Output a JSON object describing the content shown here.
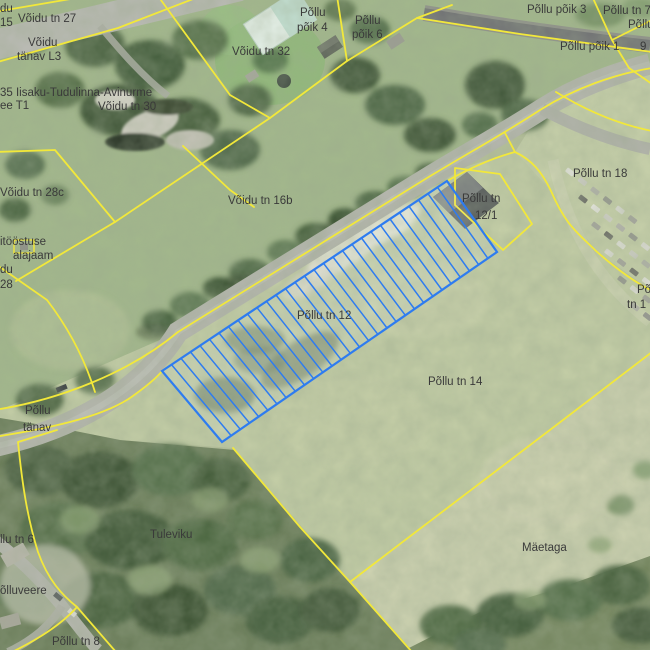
{
  "map": {
    "colors": {
      "boundary_yellow": "#f2e83a",
      "selection_blue": "#2e7cf0",
      "label_gray": "#3a3a3a"
    },
    "selected_parcel": {
      "label": "Põllu tn 12",
      "polygon": [
        [
          162,
          371
        ],
        [
          447,
          181
        ],
        [
          497,
          252
        ],
        [
          222,
          442
        ]
      ],
      "hatch_line_count": 30
    },
    "labels": [
      {
        "text": "du",
        "x": 0,
        "y": 12
      },
      {
        "text": "15",
        "x": 0,
        "y": 26
      },
      {
        "text": "Võidu tn 27",
        "x": 18,
        "y": 22
      },
      {
        "text": "Võidu",
        "x": 28,
        "y": 46
      },
      {
        "text": "tänav L3",
        "x": 17,
        "y": 60
      },
      {
        "text": "35 Iisaku-Tudulinna-Avinurme",
        "x": 0,
        "y": 96
      },
      {
        "text": "ee T1",
        "x": 0,
        "y": 109
      },
      {
        "text": "Võidu tn 30",
        "x": 98,
        "y": 110
      },
      {
        "text": "Võidu tn 32",
        "x": 232,
        "y": 55
      },
      {
        "text": "Põllu",
        "x": 300,
        "y": 16
      },
      {
        "text": "põik 4",
        "x": 297,
        "y": 31
      },
      {
        "text": "Põllu",
        "x": 355,
        "y": 24
      },
      {
        "text": "põik 6",
        "x": 352,
        "y": 38
      },
      {
        "text": "Põllu põik 3",
        "x": 527,
        "y": 13
      },
      {
        "text": "Põllu tn 7",
        "x": 603,
        "y": 14
      },
      {
        "text": "Põllu",
        "x": 628,
        "y": 28
      },
      {
        "text": "Põllu põik 1",
        "x": 560,
        "y": 50
      },
      {
        "text": "9",
        "x": 640,
        "y": 50
      },
      {
        "text": "Võidu tn 28c",
        "x": 0,
        "y": 196
      },
      {
        "text": "Võidu tn 16b",
        "x": 228,
        "y": 204
      },
      {
        "text": "Põllu tn 18",
        "x": 573,
        "y": 177
      },
      {
        "text": "Põllu tn",
        "x": 462,
        "y": 202
      },
      {
        "text": "12/1",
        "x": 475,
        "y": 219
      },
      {
        "text": "itööstuse",
        "x": 0,
        "y": 245
      },
      {
        "text": "alajaam",
        "x": 13,
        "y": 259
      },
      {
        "text": "du",
        "x": 0,
        "y": 273
      },
      {
        "text": "28",
        "x": 0,
        "y": 288
      },
      {
        "text": "Põllu tn 12",
        "x": 297,
        "y": 319
      },
      {
        "text": "Põllu tn 14",
        "x": 428,
        "y": 385
      },
      {
        "text": "Põllu",
        "x": 25,
        "y": 414
      },
      {
        "text": "tänav",
        "x": 23,
        "y": 431
      },
      {
        "text": "Põ",
        "x": 637,
        "y": 293
      },
      {
        "text": "tn 1",
        "x": 627,
        "y": 308
      },
      {
        "text": "llu tn 6",
        "x": 0,
        "y": 543
      },
      {
        "text": "õlluveere",
        "x": 0,
        "y": 594
      },
      {
        "text": "Tuleviku",
        "x": 150,
        "y": 538
      },
      {
        "text": "Mäetaga",
        "x": 522,
        "y": 551
      },
      {
        "text": "Põllu tn 8",
        "x": 52,
        "y": 645
      }
    ]
  }
}
